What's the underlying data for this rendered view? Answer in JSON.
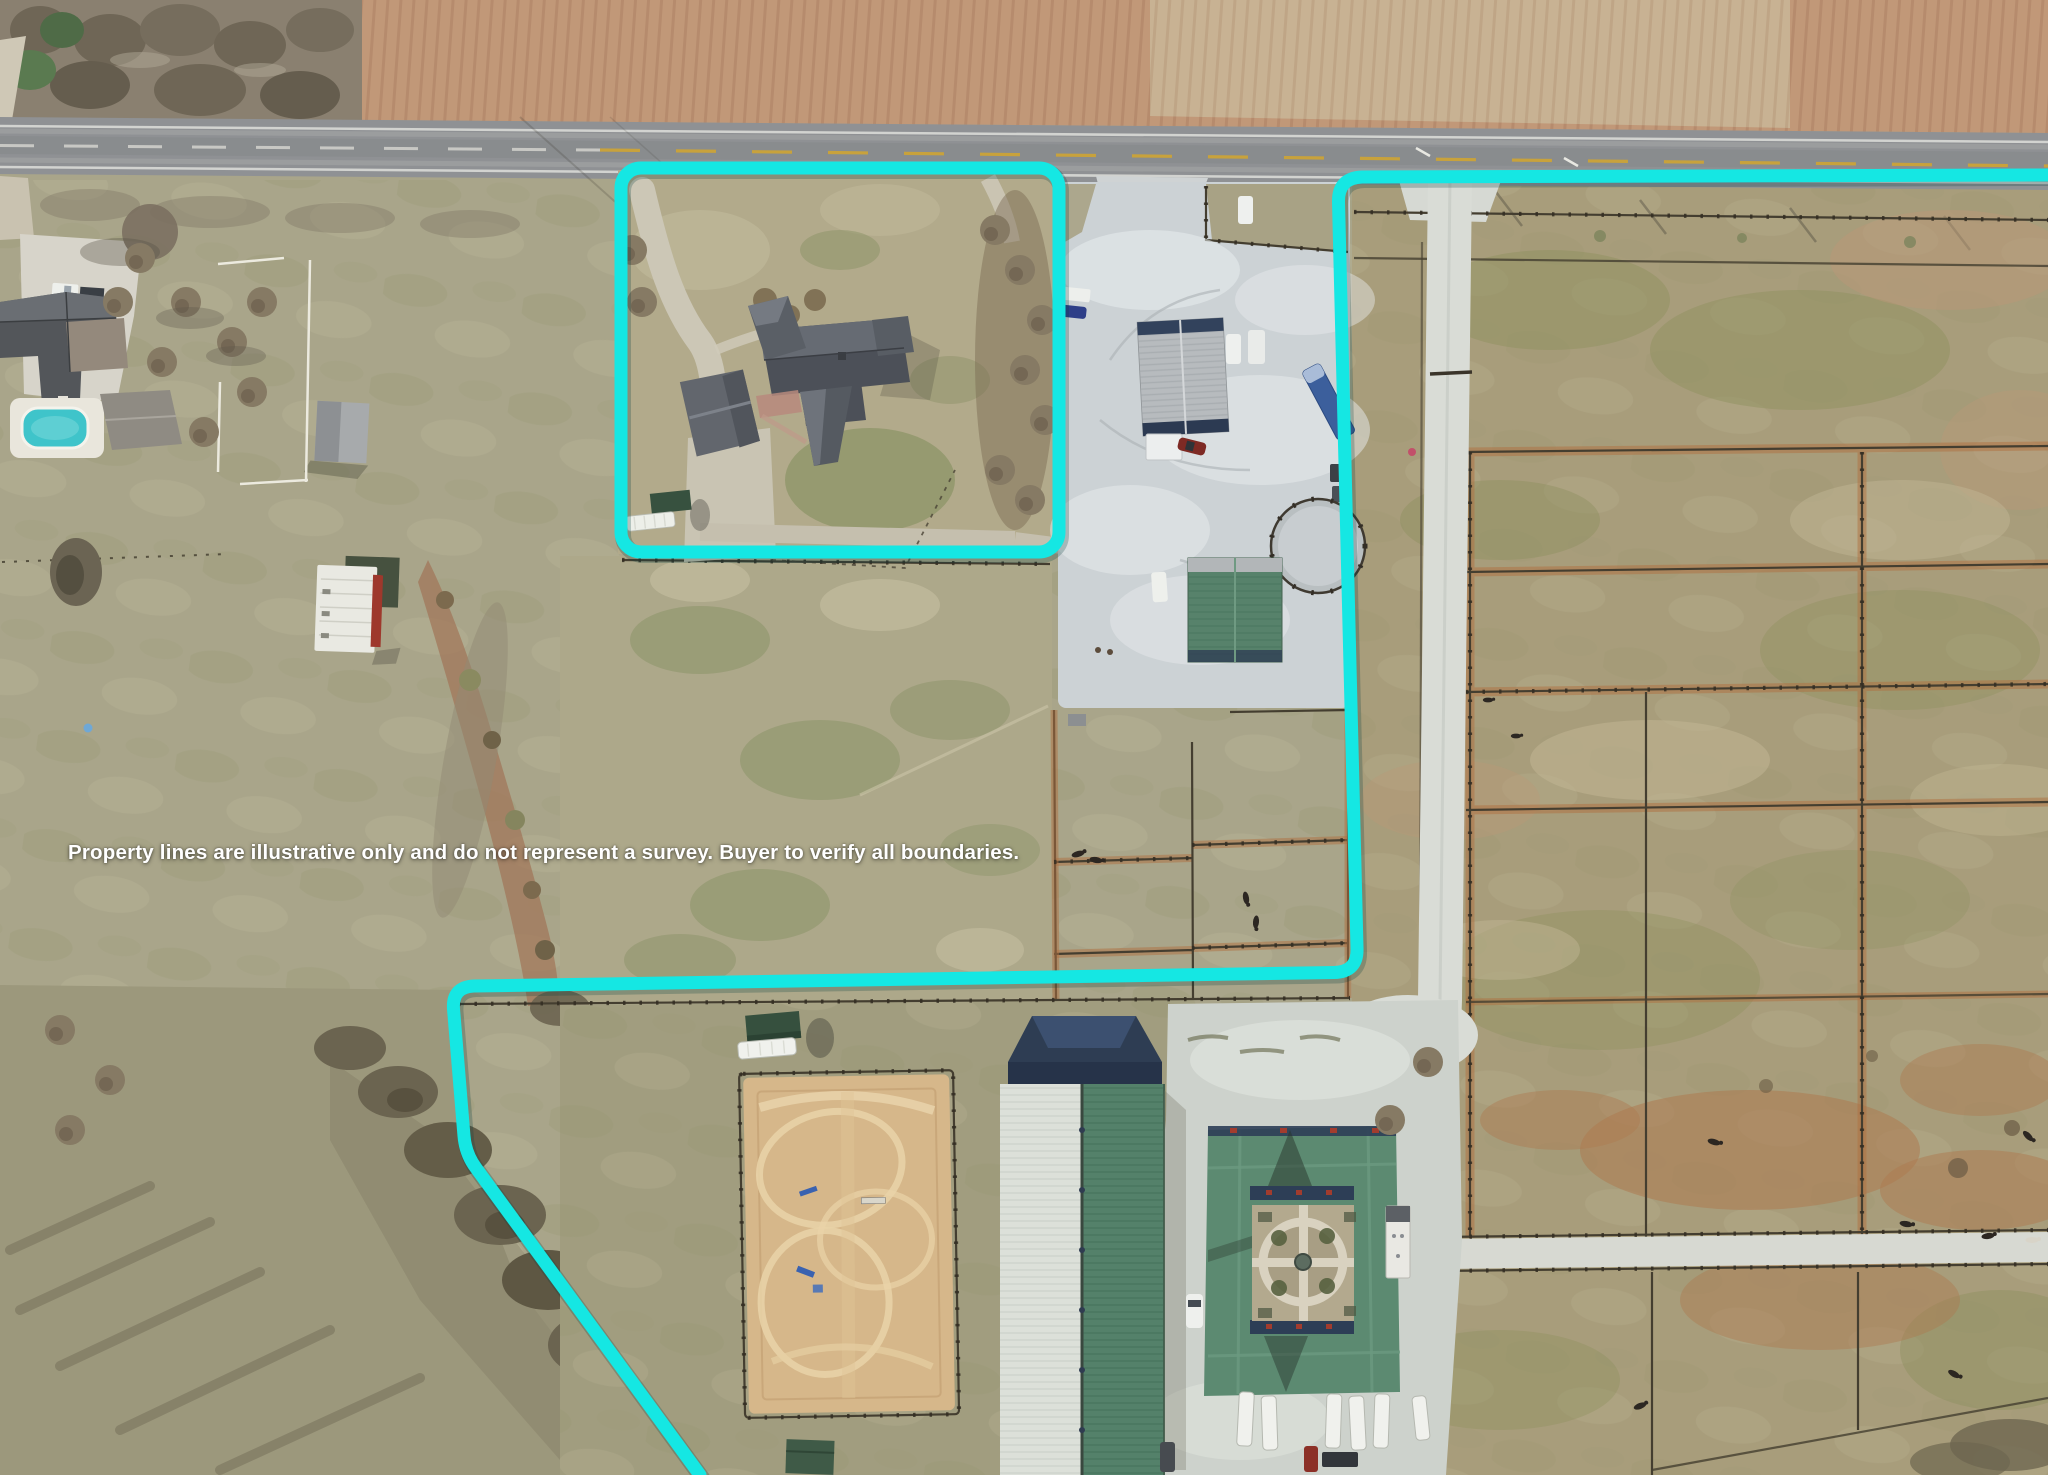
{
  "meta": {
    "type": "aerial-property-photo",
    "width": 2048,
    "height": 1475
  },
  "overlay": {
    "disclaimer": "Property lines are illustrative only and do not represent a survey. Buyer to verify all boundaries."
  },
  "colors": {
    "boundary": "#15e7e3",
    "text": "#ffffff",
    "road": "#8f9194",
    "gravel": "#ccd2d5",
    "gravel_road": "#d9dcd6",
    "sand": "#d6b78a",
    "pool": "#3fc4ca",
    "barn_light": "#dce0d9",
    "barn_green": "#54816a",
    "stable_green": "#5c8a71",
    "fence": "#443e30",
    "dirt": "#b0703f",
    "field": "#a9a58a"
  }
}
